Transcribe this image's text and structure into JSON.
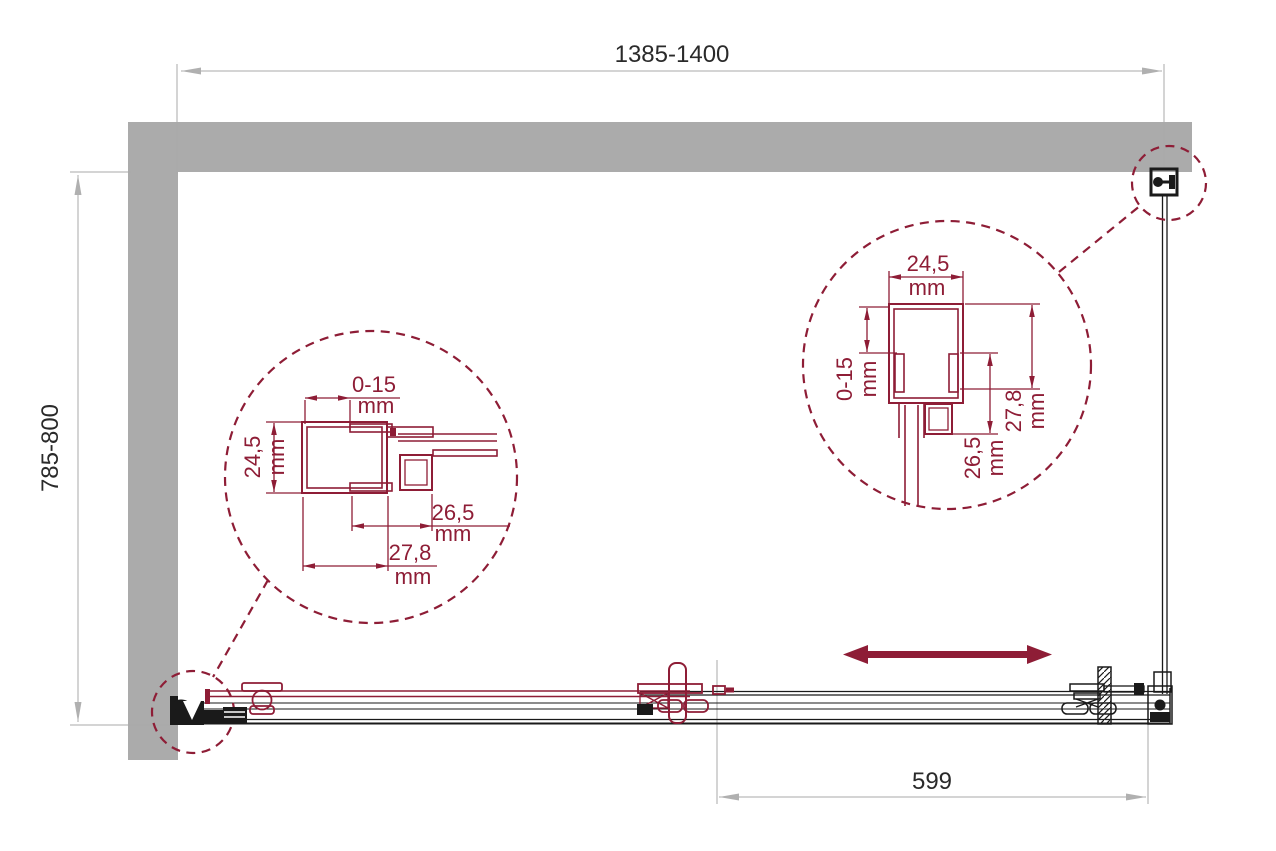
{
  "drawing": {
    "type": "sliding shower enclosure - plan view installation drawing",
    "colors": {
      "accent": "#8e1d36",
      "wall": "#ababab",
      "dim_lines": "#a8a8a8",
      "ink": "#1a1a1a"
    },
    "dimensions": {
      "overall_width": "1385-1400",
      "overall_depth": "785-800",
      "door_travel": "599"
    },
    "detail_left": {
      "adjustment": {
        "value": "0-15",
        "unit": "mm"
      },
      "profile_width": {
        "value": "24,5",
        "unit": "mm"
      },
      "depth_inner": {
        "value": "26,5",
        "unit": "mm"
      },
      "depth_outer": {
        "value": "27,8",
        "unit": "mm"
      }
    },
    "detail_right": {
      "profile_width": {
        "value": "24,5",
        "unit": "mm"
      },
      "adjustment": {
        "value": "0-15",
        "unit": "mm"
      },
      "depth_inner": {
        "value": "26,5",
        "unit": "mm"
      },
      "depth_outer": {
        "value": "27,8",
        "unit": "mm"
      }
    }
  }
}
